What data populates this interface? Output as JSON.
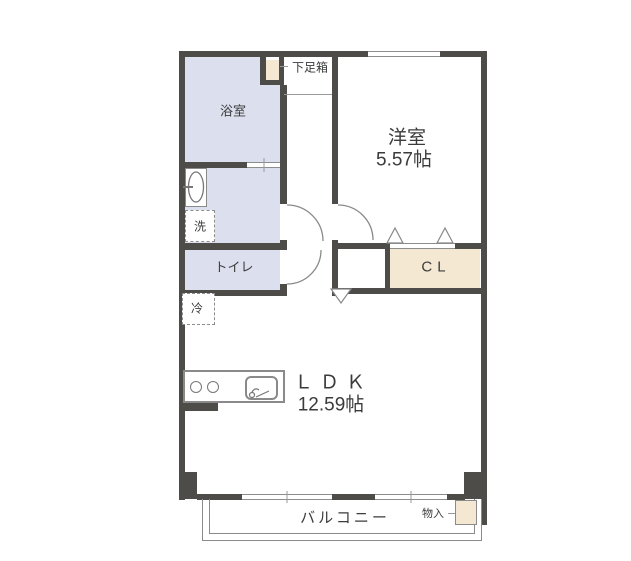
{
  "rooms": {
    "bathroom": {
      "label": "浴室"
    },
    "bedroom": {
      "label": "洋室",
      "size": "5.57帖"
    },
    "ldk": {
      "label": "ＬＤＫ",
      "size": "12.59帖"
    },
    "toilet": {
      "label": "トイレ"
    },
    "closet": {
      "label": "CL"
    },
    "balcony": {
      "label": "バルコニー"
    },
    "shoe_cabinet": {
      "label": "下足箱"
    },
    "washer_space": {
      "label": "洗"
    },
    "fridge_space": {
      "label": "冷"
    },
    "storage": {
      "label": "物入"
    }
  },
  "colors": {
    "wall": "#4e4c49",
    "wet_area_fill": "#dcdfee",
    "closet_fill": "#f5e8d3",
    "outline": "#8a8a8a",
    "text": "#3b3b3b"
  }
}
